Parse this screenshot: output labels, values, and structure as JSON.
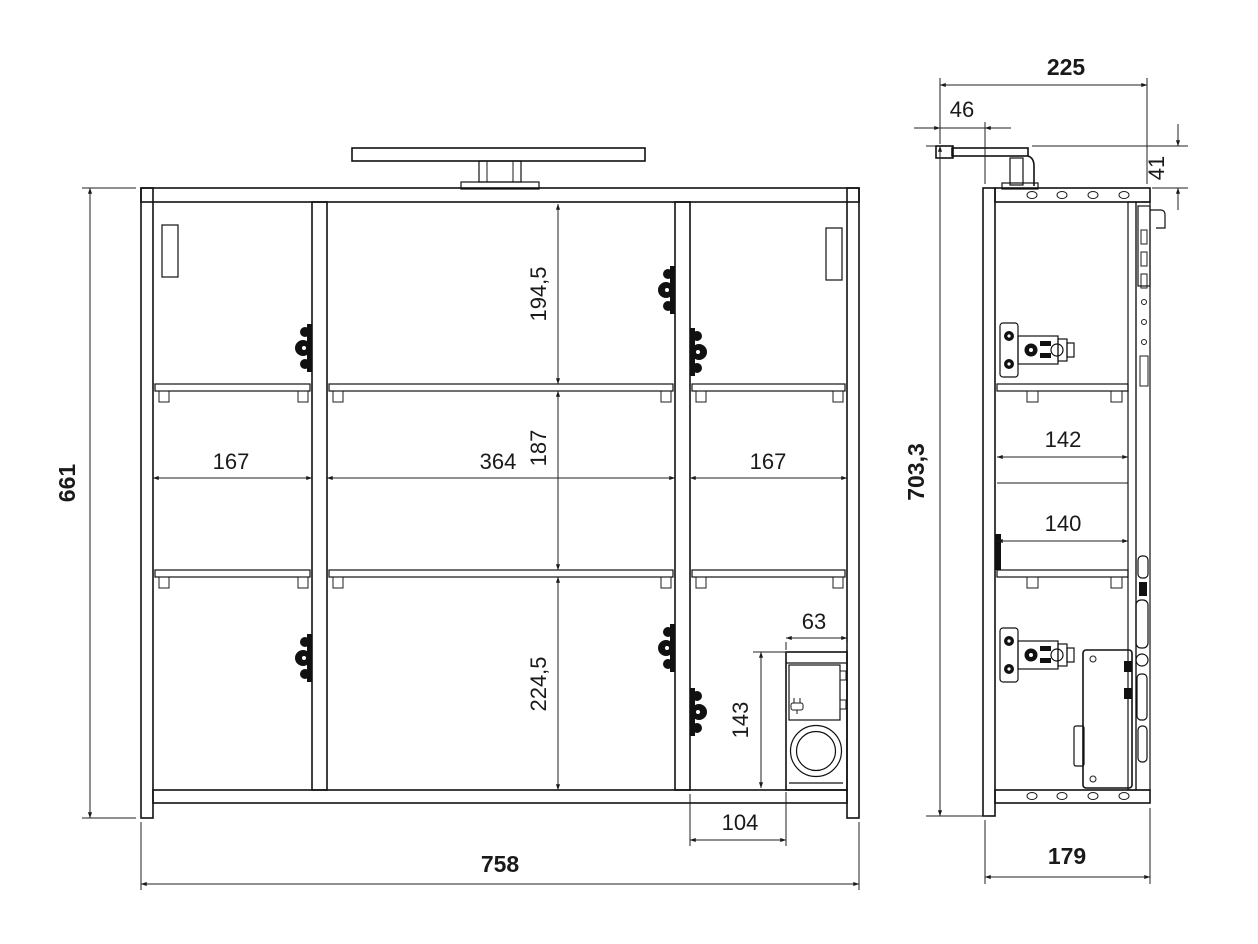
{
  "drawing": {
    "type": "furniture technical drawing, mirror cabinet with lamp, front and side view",
    "colors": {
      "background": "#ffffff",
      "line": "#111111",
      "dim_line": "#222222",
      "text": "#1a1a1a",
      "hinge_fill": "#111111"
    },
    "icons": {
      "plug": "power-plug"
    },
    "front": {
      "total_width": "758",
      "total_height": "661",
      "left_width": "167",
      "center_width": "364",
      "right_width": "167",
      "top_row": "194,5",
      "mid_row": "187",
      "bottom_row": "224,5",
      "socket_w": "63",
      "socket_h": "143",
      "socket_off": "104"
    },
    "side": {
      "depth": "225",
      "lamp_front": "46",
      "lamp_up": "41",
      "full_height": "703,3",
      "depth_upper": "142",
      "depth_lower": "140",
      "body_depth": "179"
    }
  }
}
